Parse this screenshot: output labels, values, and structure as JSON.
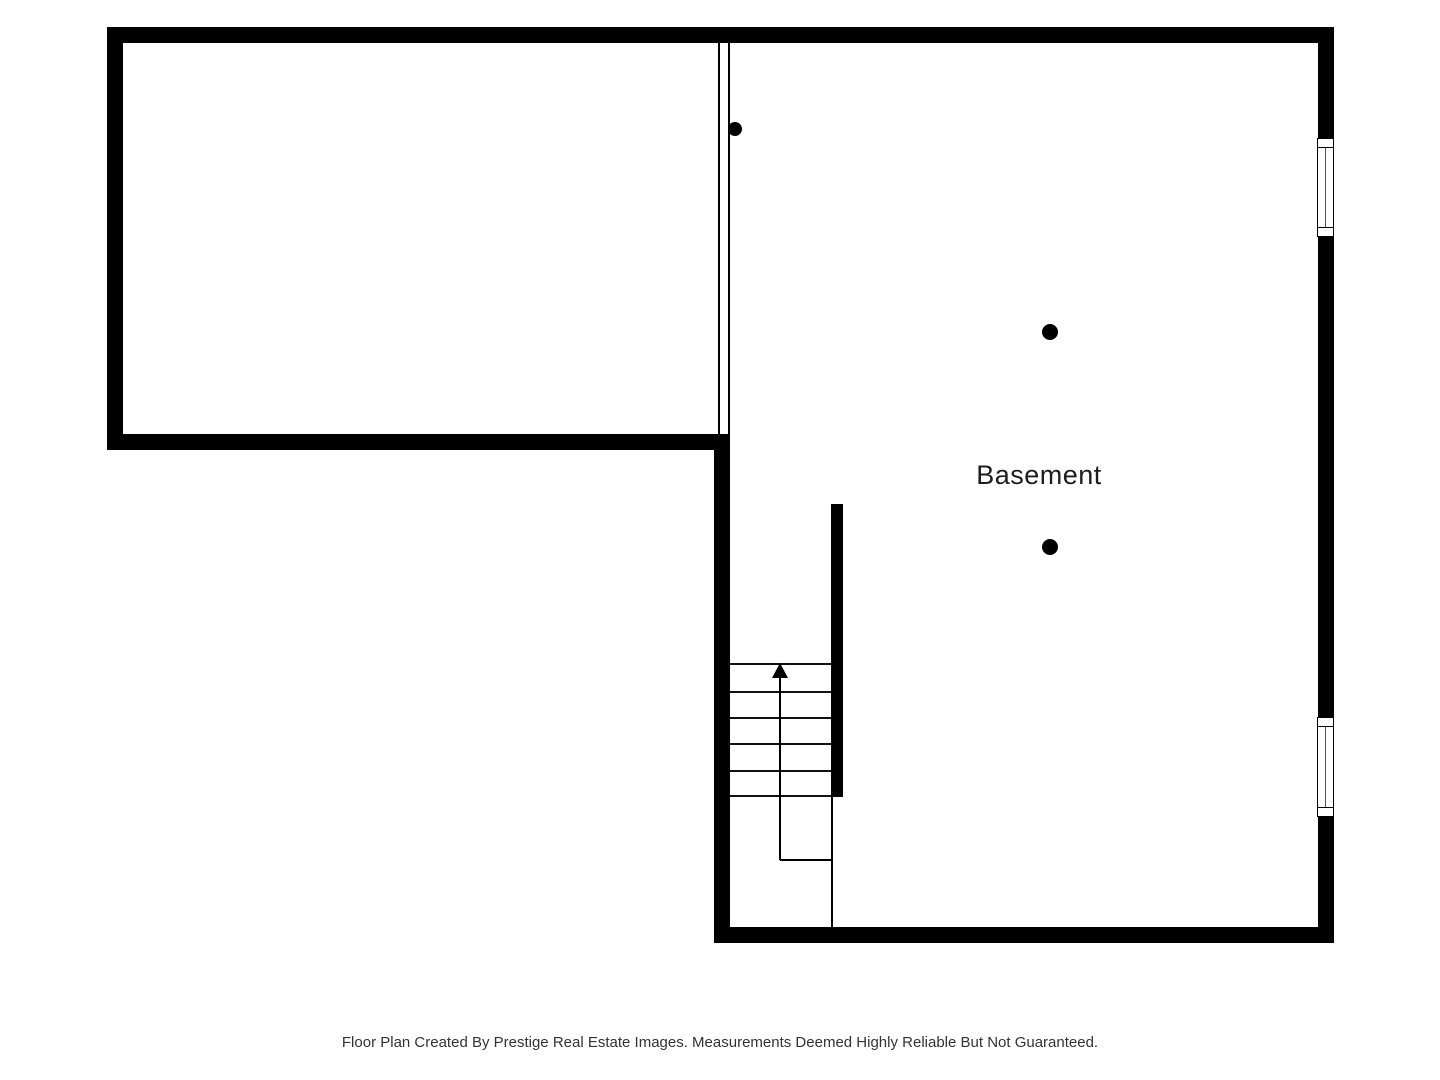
{
  "labels": {
    "room": "Basement",
    "footer": "Floor Plan Created By Prestige Real Estate Images. Measurements Deemed Highly Reliable But Not Guaranteed."
  },
  "colors": {
    "wall": "#000000",
    "floor": "#ffffff",
    "window_glass_line": "#555555",
    "room_label_text": "#1d1d1d",
    "footer_text": "#333333"
  },
  "features": {
    "stair_direction": "up",
    "stair_tread_count": 5,
    "window_count": 2,
    "support_column_count": 3
  }
}
